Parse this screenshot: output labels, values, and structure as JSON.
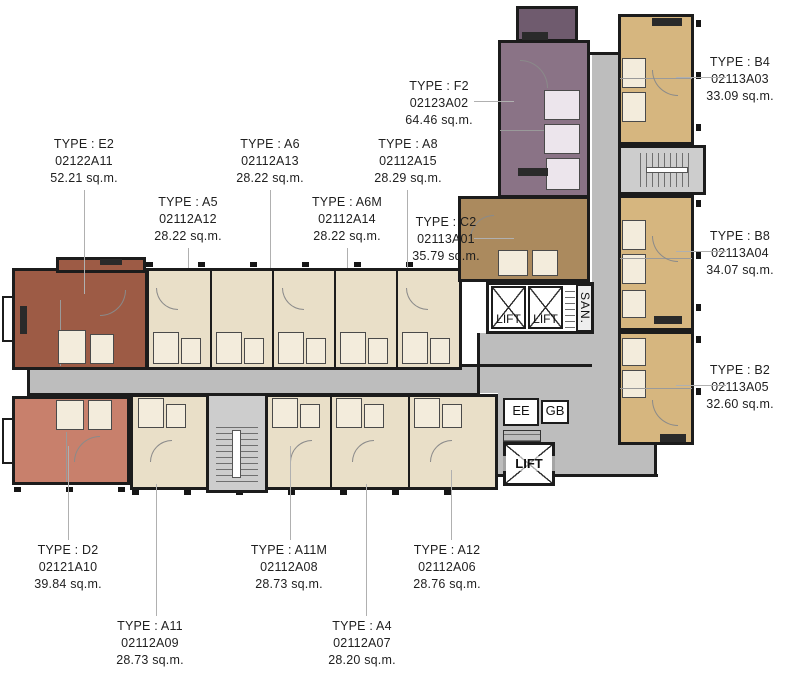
{
  "units": [
    {
      "id": "E2",
      "type": "TYPE : E2",
      "code": "02122A11",
      "area": "52.21 sq.m."
    },
    {
      "id": "A5",
      "type": "TYPE : A5",
      "code": "02112A12",
      "area": "28.22 sq.m."
    },
    {
      "id": "A6",
      "type": "TYPE : A6",
      "code": "02112A13",
      "area": "28.22 sq.m."
    },
    {
      "id": "A6M",
      "type": "TYPE : A6M",
      "code": "02112A14",
      "area": "28.22 sq.m."
    },
    {
      "id": "A8",
      "type": "TYPE : A8",
      "code": "02112A15",
      "area": "28.29 sq.m."
    },
    {
      "id": "F2",
      "type": "TYPE : F2",
      "code": "02123A02",
      "area": "64.46 sq.m."
    },
    {
      "id": "C2",
      "type": "TYPE : C2",
      "code": "02113A01",
      "area": "35.79 sq.m."
    },
    {
      "id": "B4",
      "type": "TYPE : B4",
      "code": "02113A03",
      "area": "33.09 sq.m."
    },
    {
      "id": "B8",
      "type": "TYPE : B8",
      "code": "02113A04",
      "area": "34.07 sq.m."
    },
    {
      "id": "B2",
      "type": "TYPE : B2",
      "code": "02113A05",
      "area": "32.60 sq.m."
    },
    {
      "id": "D2",
      "type": "TYPE : D2",
      "code": "02121A10",
      "area": "39.84 sq.m."
    },
    {
      "id": "A11",
      "type": "TYPE : A11",
      "code": "02112A09",
      "area": "28.73 sq.m."
    },
    {
      "id": "A11M",
      "type": "TYPE : A11M",
      "code": "02112A08",
      "area": "28.73 sq.m."
    },
    {
      "id": "A4",
      "type": "TYPE : A4",
      "code": "02112A07",
      "area": "28.20 sq.m."
    },
    {
      "id": "A12",
      "type": "TYPE : A12",
      "code": "02112A06",
      "area": "28.76 sq.m."
    }
  ],
  "cores": {
    "lift": "LIFT",
    "san": "SAN.",
    "ee": "EE",
    "gb": "GB"
  },
  "colors": {
    "unit_e2": "#9d5b45",
    "unit_d2": "#c8806c",
    "unit_a_beige": "#e9dfc8",
    "unit_b_tan": "#d6b67f",
    "unit_c2": "#ab8a5e",
    "unit_f2": "#8a7386",
    "unit_f2_dark": "#6f5b6e",
    "corridor": "#bdbdbd",
    "stair": "#cdcdcd",
    "wall": "#1c1c1c",
    "pod": "#f3ecdc",
    "leader": "#b0b0b0"
  }
}
